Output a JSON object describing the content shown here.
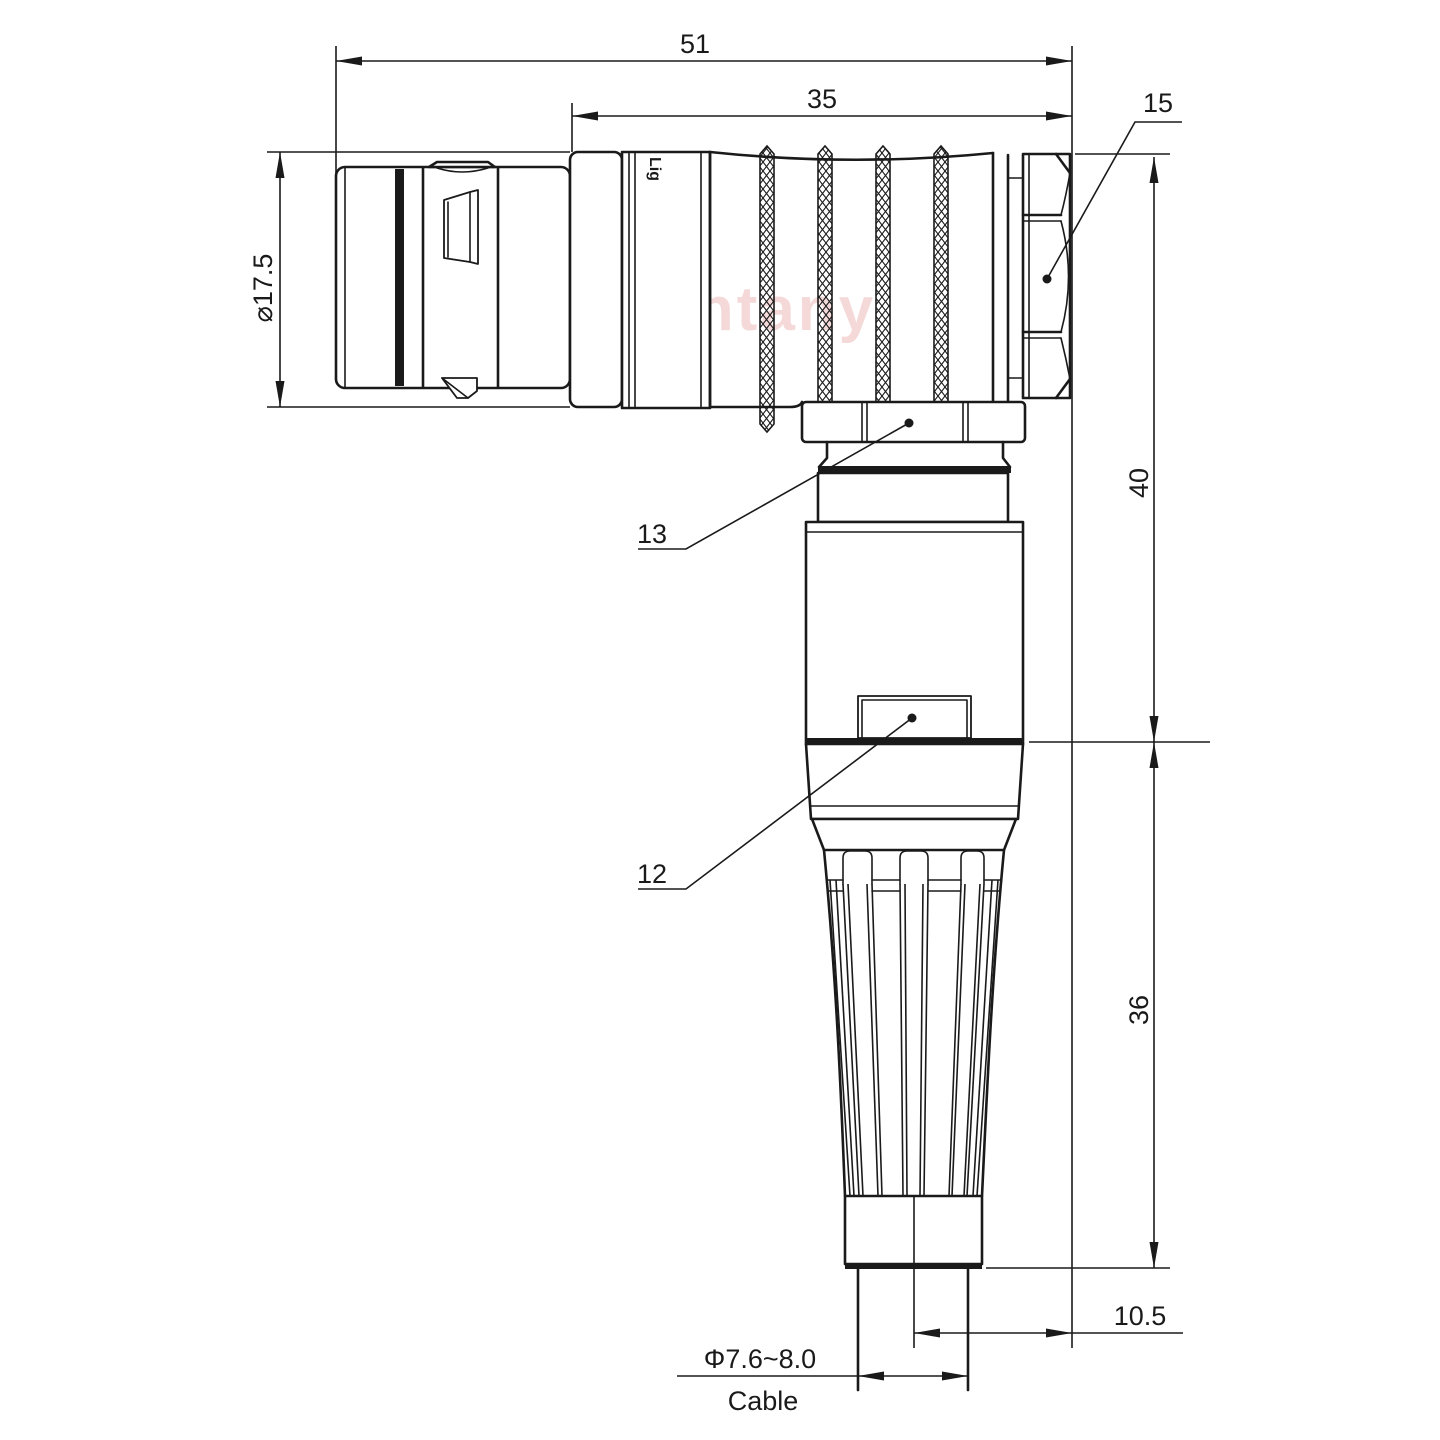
{
  "drawing": {
    "type": "right-angle connector technical drawing",
    "watermark": "Lightany",
    "body_marking": "Lig",
    "colors": {
      "line": "#1a1a1a",
      "background": "#ffffff",
      "watermark": "#e8a5a5"
    },
    "labels": {
      "overall_length": "51",
      "front_length": "35",
      "backnut_ref": "15",
      "plug_diameter": "⌀17.5",
      "height_upper": "40",
      "height_lower": "36",
      "coupling_ref": "13",
      "housing_ref": "12",
      "cable_offset": "10.5",
      "cable_diameter": "Φ7.6~8.0",
      "cable_label": "Cable"
    }
  }
}
